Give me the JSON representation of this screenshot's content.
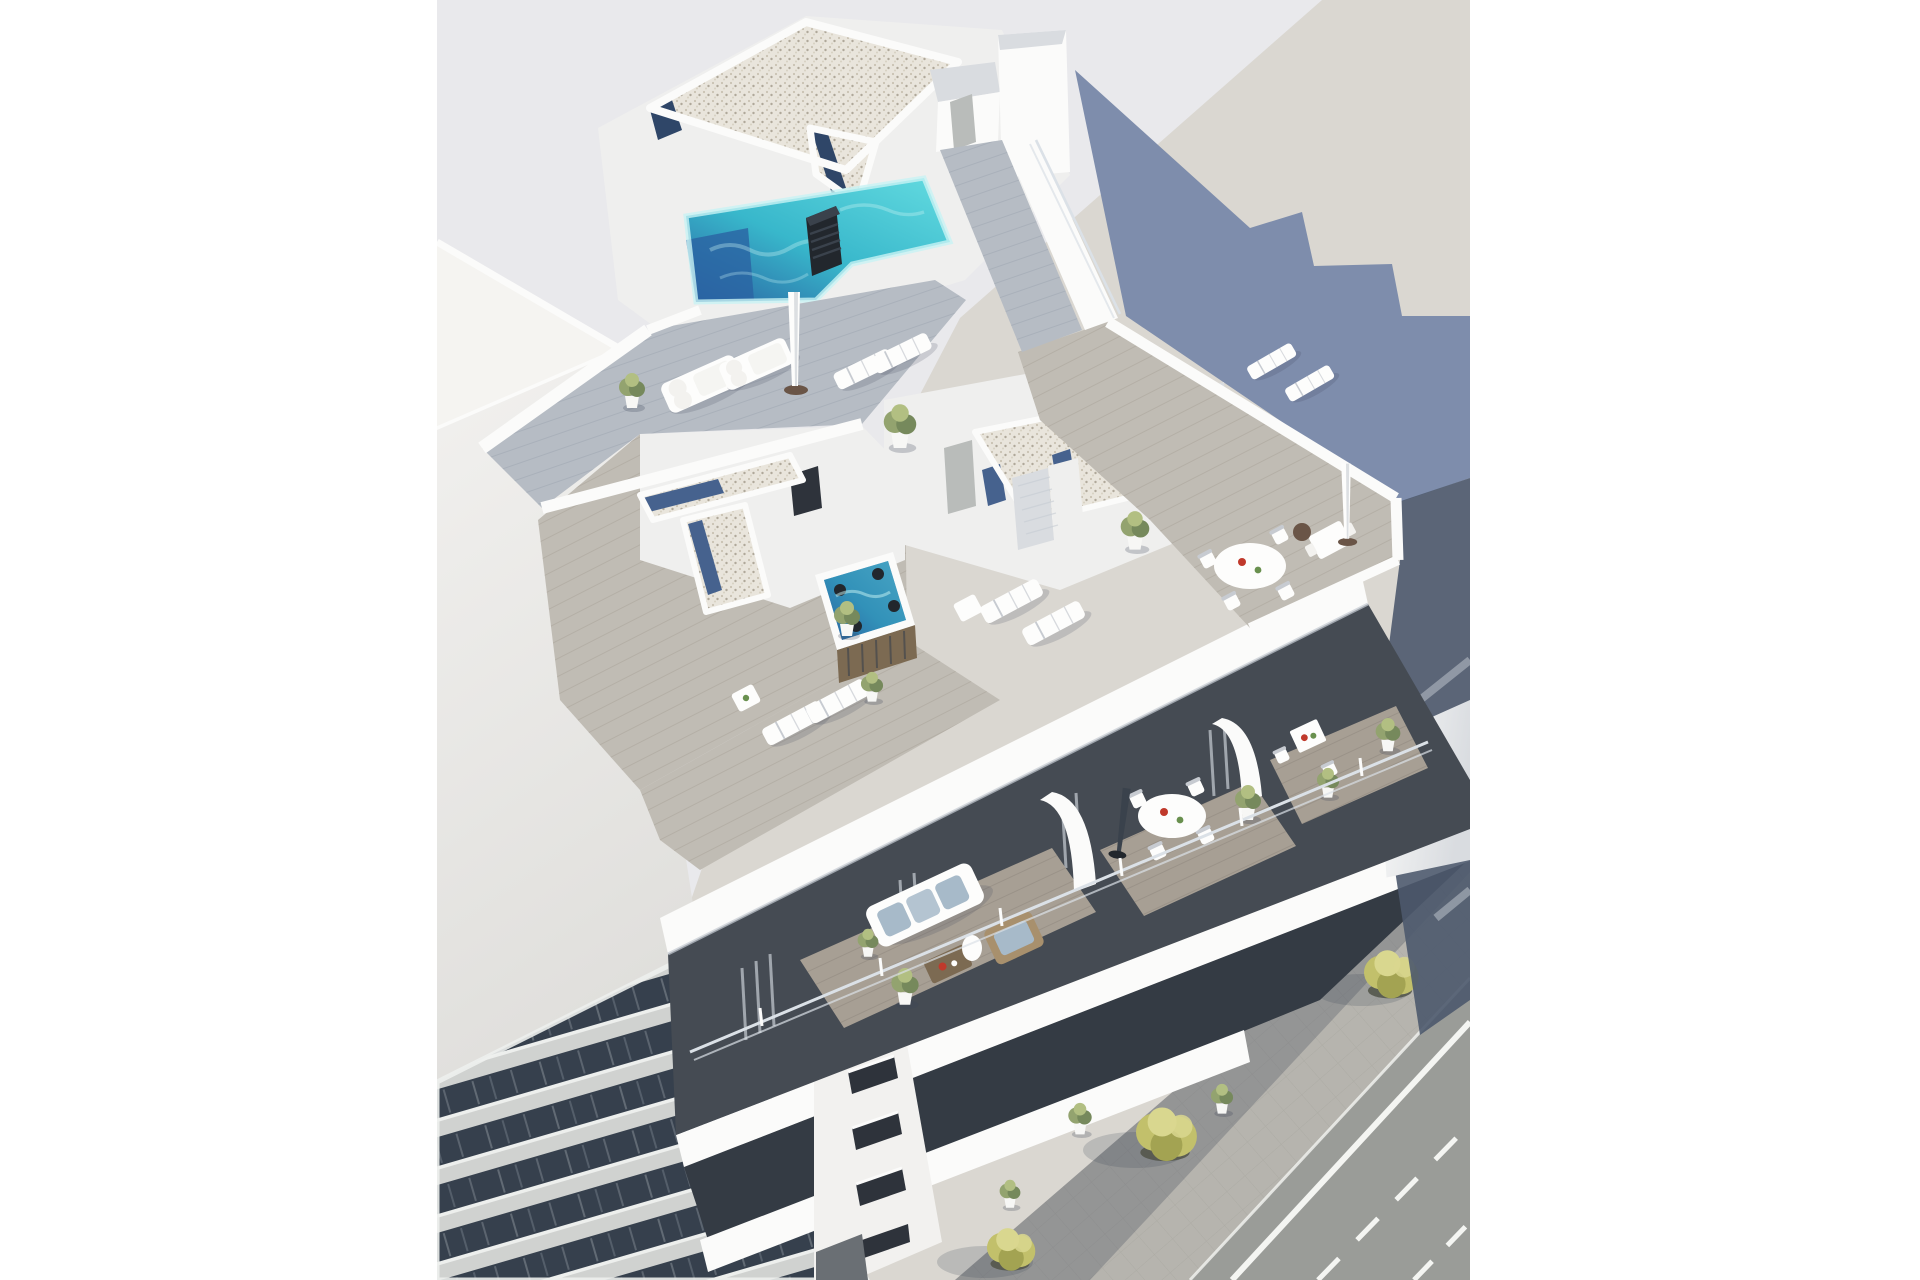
{
  "meta": {
    "kind": "architectural-3d-render",
    "subject": "aerial-view-of-modern-white-apartment-building-with-rooftop-pool-and-terraces"
  },
  "palette": {
    "page_bg": "#ffffff",
    "backdrop": "#e9e9ec",
    "ground_sun": "#dad7d1",
    "shadow_cast": "#7e8dac",
    "shadow_side": "#4d596d",
    "road": "#9a9c98",
    "road_line": "#f4f5f2",
    "sidewalk": "#b6b4ae",
    "sidewalk_shade": "#3c4556",
    "paver_line": "#8e8c86",
    "tree_well": "#54564c",
    "tree_dark": "#a3a352",
    "tree_mid": "#c2c06b",
    "tree_light": "#d9d78f",
    "left_roof": "#f5f4f1",
    "left_wall_top": "#f2f1ef",
    "left_wall_bottom": "#e0dfdc",
    "band_slab": "#d0d2d0",
    "band_slab_lit": "#edefed",
    "band_gap": "#36404d",
    "white_lit": "#fbfbfa",
    "white_mid": "#efefee",
    "white_shade": "#d9dce0",
    "white_dark": "#c6ccd3",
    "gravel_base": "#e9e5dc",
    "gravel_dot1": "#c9c2b2",
    "gravel_dot2": "#afa89a",
    "gravel_dot3": "#d6d0c2",
    "skylight": "#46628e",
    "skylight_dark": "#2f4668",
    "pool_deep": "#2a63a2",
    "pool_mid": "#38b7cb",
    "pool_light": "#63dbe0",
    "pool_foam": "#c8f3f4",
    "chimney_dark": "#22272d",
    "chimney_mid": "#3a424c",
    "deckA": "#b6bcc4",
    "deckA_line": "#99a1ac",
    "deckB": "#c0bcb4",
    "deckB_line": "#a59f94",
    "deckC": "#a79f94",
    "deckC_line": "#8e867b",
    "facade_dark": "#454b53",
    "facade_darker": "#343b44",
    "curtain": "#b0b6bd",
    "door_gray": "#b9bcba",
    "window_dark": "#2e333b",
    "furn_white": "#fdfdfc",
    "furn_shadow": "#c7cbd1",
    "cushion": "#f3f2ef",
    "cushion_blue": "#a7bac9",
    "wood": "#a8906d",
    "wood_dark": "#7c6a52",
    "red_accent": "#c0392b",
    "green_accent": "#69904e",
    "plant_dark": "#76895c",
    "plant_mid": "#93a36f",
    "plant_light": "#b2bf82",
    "pot_white": "#f7f7f5",
    "glass_rail": "#dbe1e7",
    "base_brown": "#6a5547",
    "garage": "#6a6f74"
  },
  "scene_labels": {
    "pool": "rooftop-swimming-pool",
    "jacuzzi": "rooftop-jacuzzi",
    "street": "street-with-lane-markings",
    "left_building": "adjacent-apartment-building",
    "main_building": "main-apartment-building",
    "shadow": "building-cast-shadow",
    "trees": "street-trees"
  }
}
